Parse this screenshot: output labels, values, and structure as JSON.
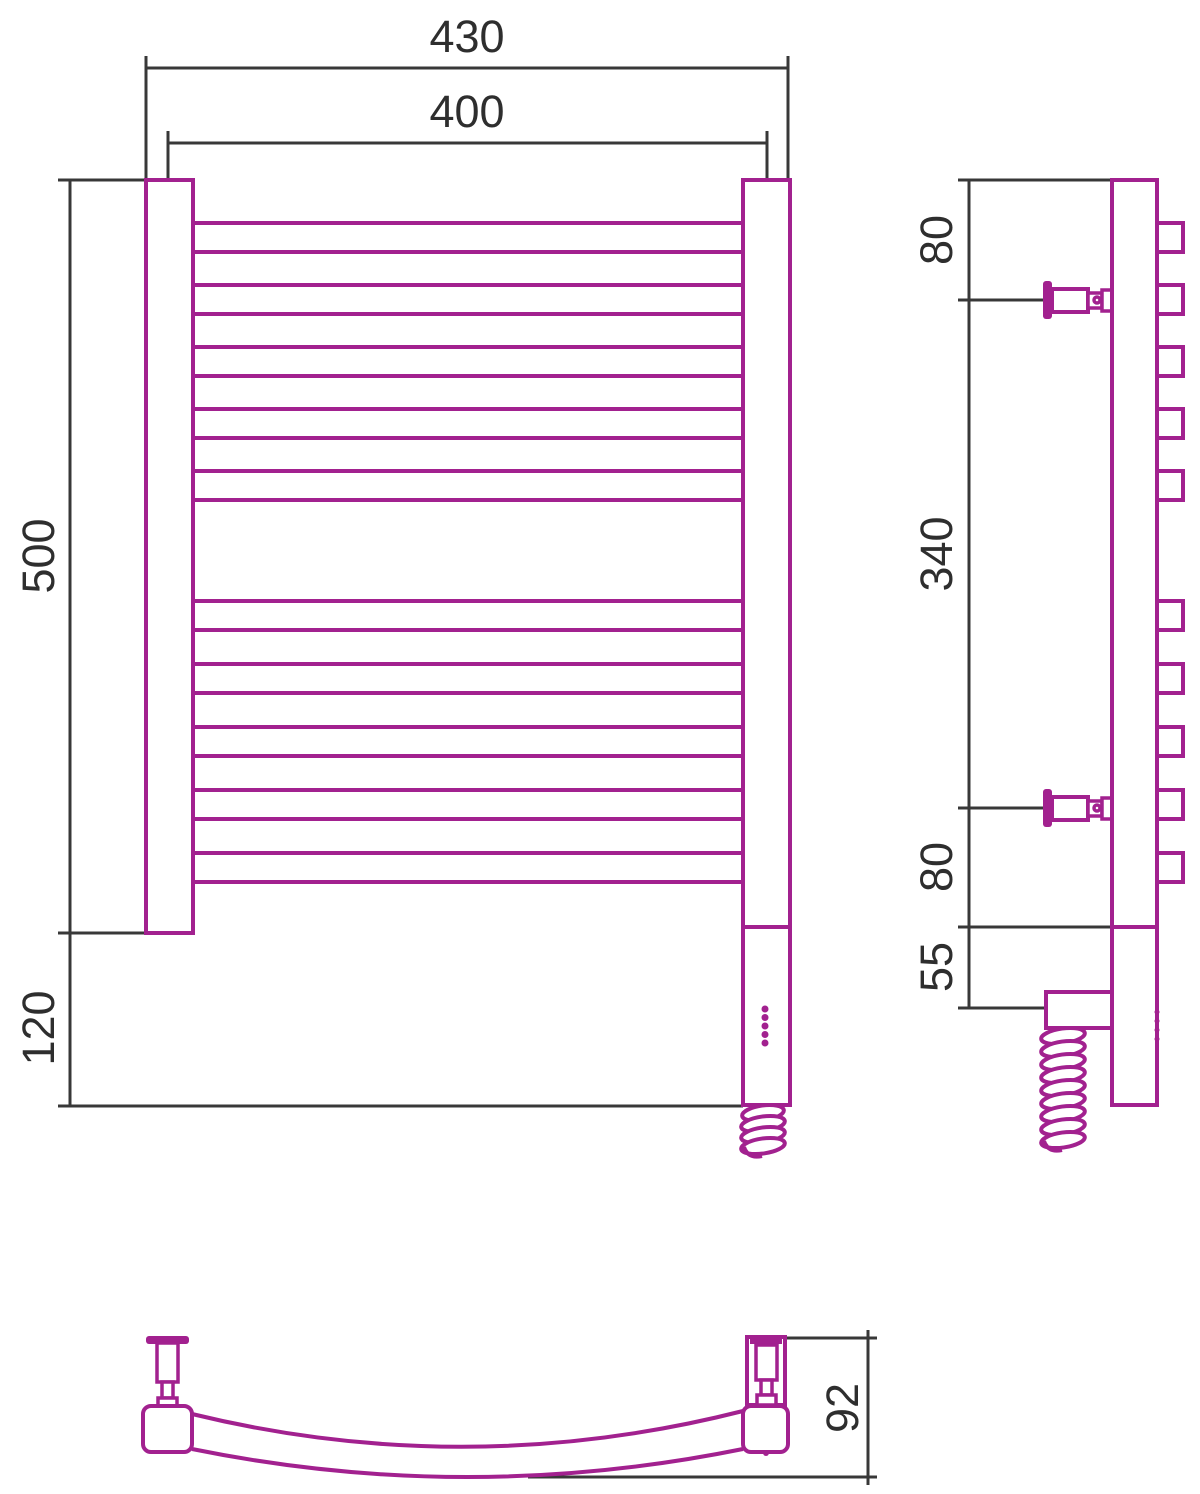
{
  "drawing": {
    "background_color": "#ffffff",
    "product_line_color": "#a2218f",
    "dimension_line_color": "#383838",
    "views": {
      "front": {
        "rung_count": 10,
        "rung_groups": [
          5,
          5
        ],
        "led_indicator_dots": 5,
        "dimensions": {
          "overall_width": "430",
          "center_width": "400",
          "body_height": "500",
          "lower_extension": "120"
        }
      },
      "side": {
        "rung_tab_count": 10,
        "wall_bracket_count": 2,
        "dimensions": {
          "top_to_bracket": "80",
          "bracket_span": "340",
          "bracket_to_base": "80",
          "electric_section": "55"
        }
      },
      "bottom": {
        "dimensions": {
          "depth": "92"
        }
      }
    }
  }
}
